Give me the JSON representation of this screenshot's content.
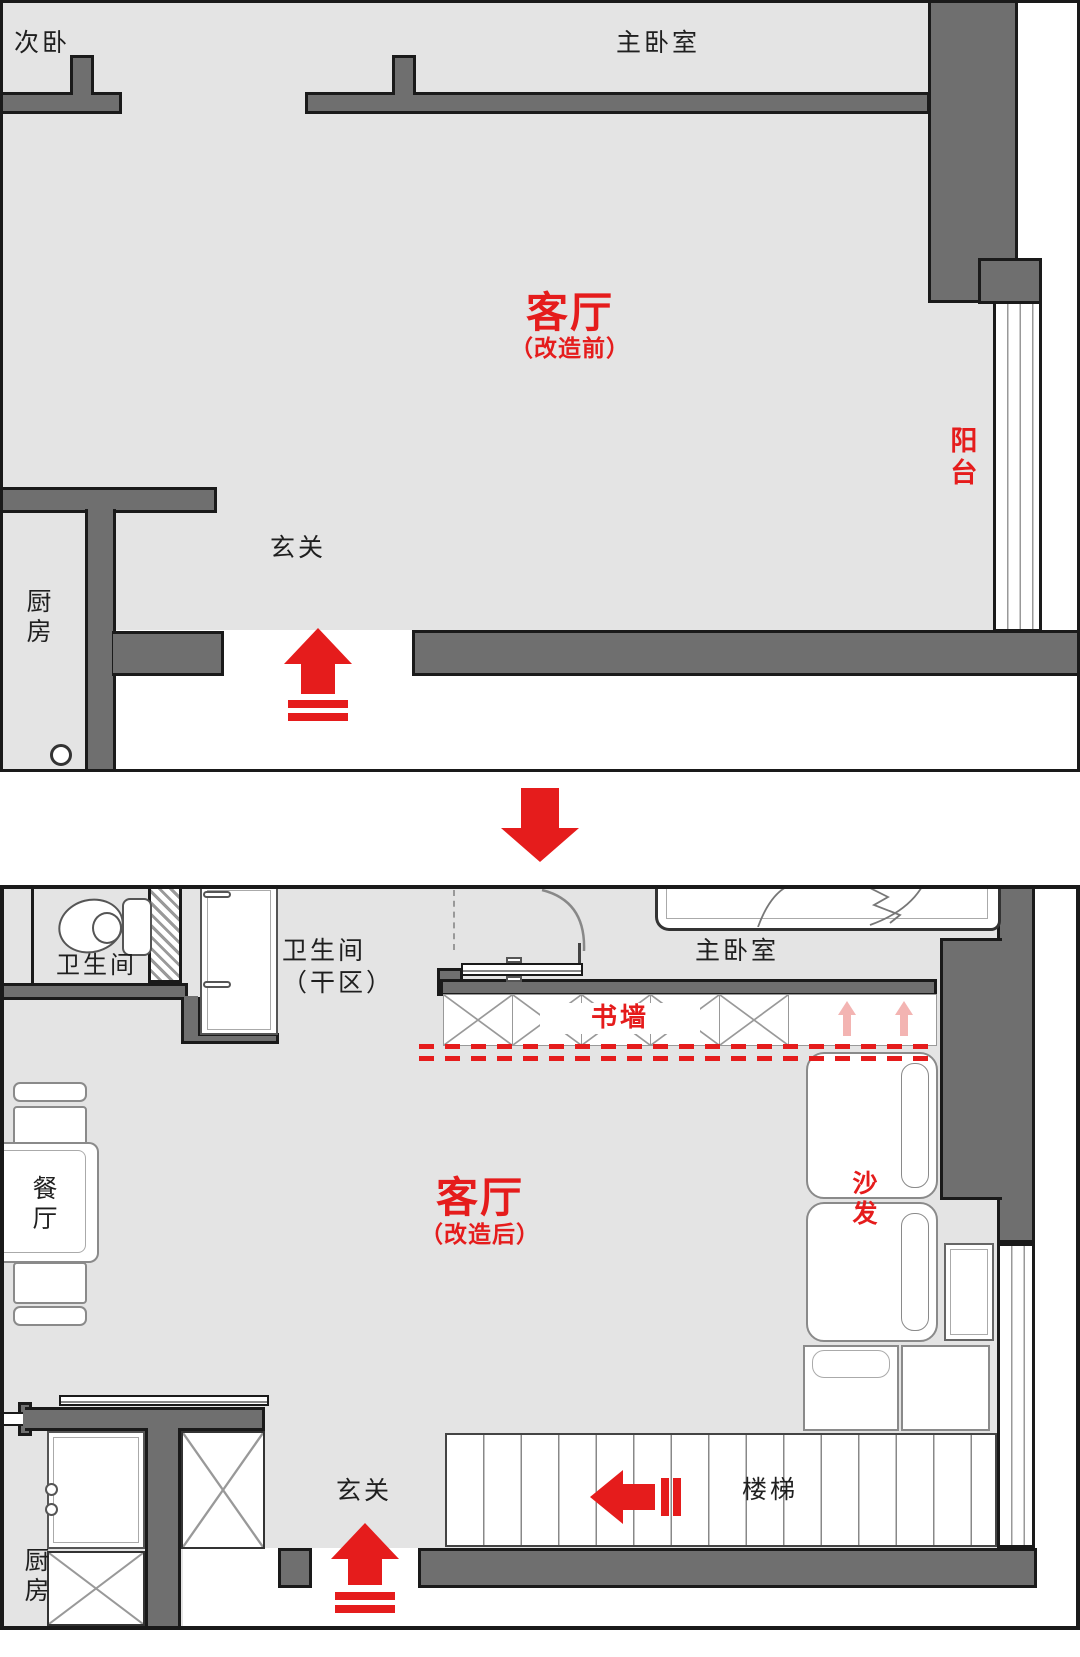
{
  "colors": {
    "accent_red": "#e51c1c",
    "soft_pink": "#f3b4b2",
    "wall_gray": "#6f6f6f",
    "floor_gray": "#e4e4e4",
    "outline_black": "#1a1a1a"
  },
  "plan_before": {
    "labels": {
      "second_bedroom": "次卧",
      "master_bedroom": "主卧室",
      "living_room": "客厅",
      "living_room_note": "（改造前）",
      "balcony": "阳台",
      "entry": "玄关",
      "kitchen": "厨房"
    }
  },
  "plan_after": {
    "labels": {
      "bathroom": "卫生间",
      "bathroom_dry_line1": "卫生间",
      "bathroom_dry_line2": "（干区）",
      "master_bedroom": "主卧室",
      "book_wall": "书墙",
      "sofa": "沙发",
      "dining_room": "餐厅",
      "living_room": "客厅",
      "living_room_note": "（改造后）",
      "entry": "玄关",
      "stairs": "楼梯",
      "kitchen": "厨房"
    }
  }
}
